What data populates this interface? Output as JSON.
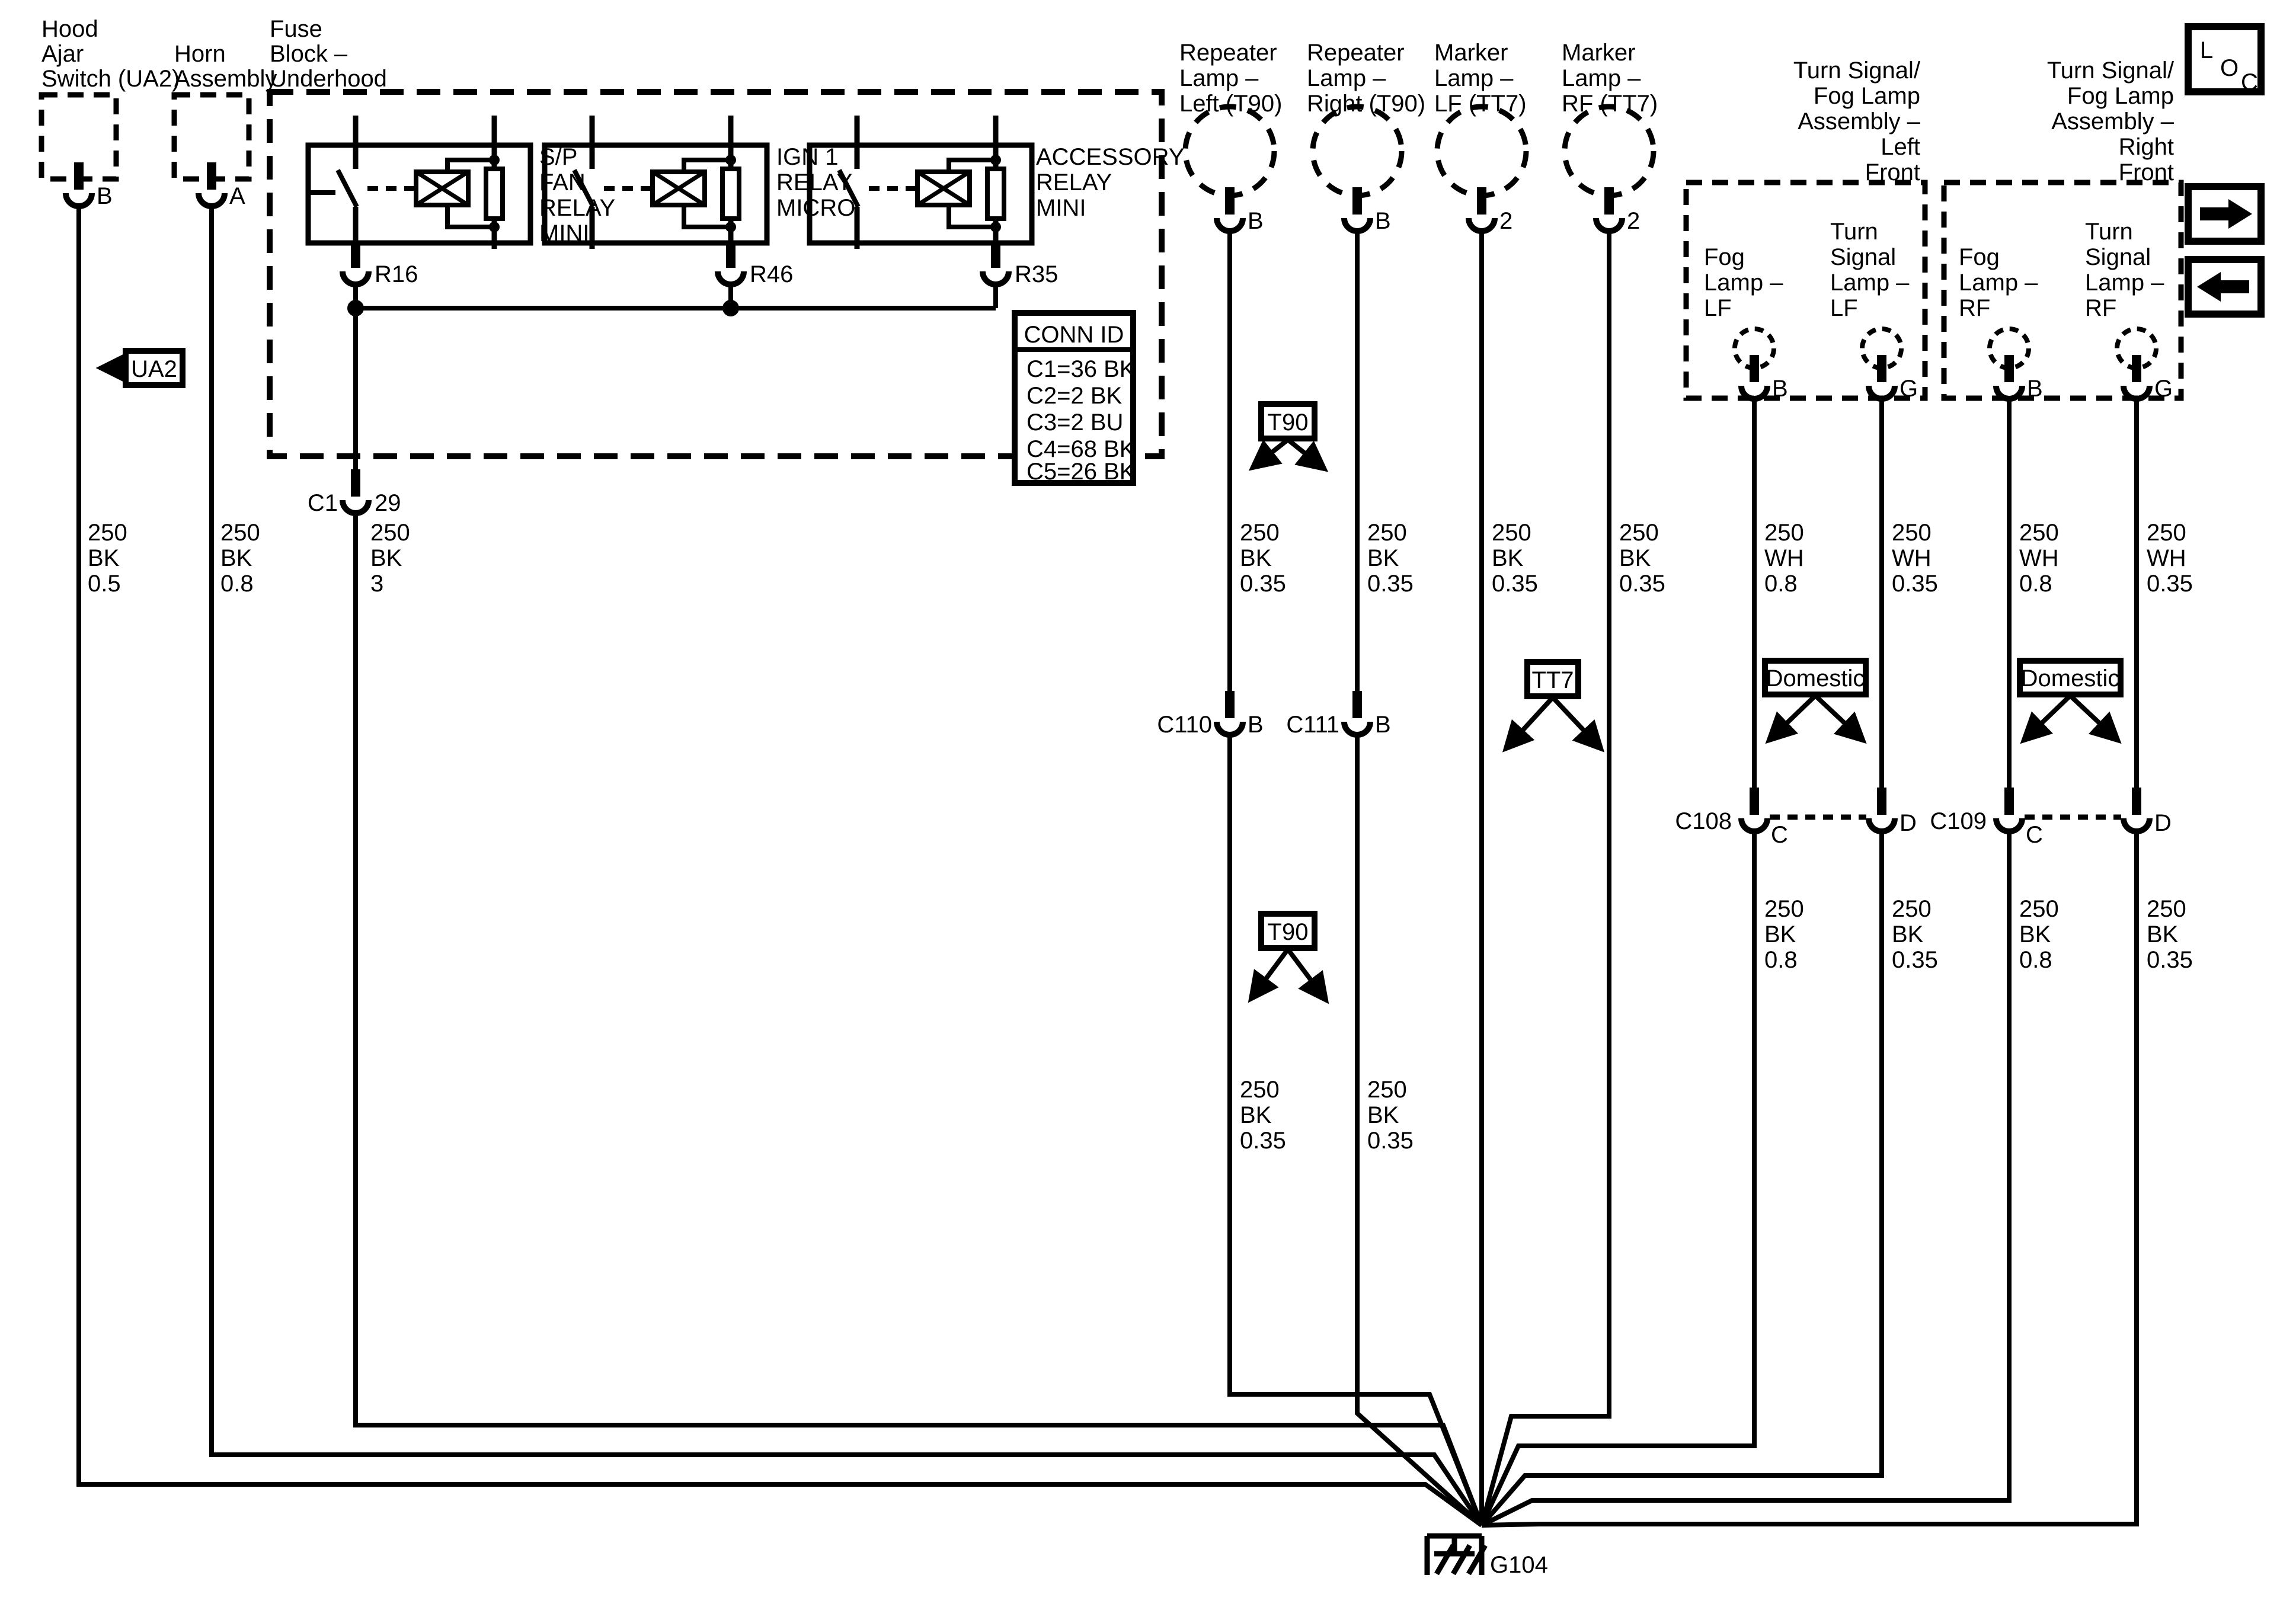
{
  "colors": {
    "ink": "#000000",
    "paper": "#ffffff"
  },
  "hood_ajar": {
    "line1": "Hood",
    "line2": "Ajar",
    "line3": "Switch (UA2)",
    "pin": "B",
    "wire1": "250",
    "wire2": "BK",
    "wire3": "0.5"
  },
  "horn": {
    "line1": "Horn",
    "line2": "Assembly",
    "pin": "A",
    "wire1": "250",
    "wire2": "BK",
    "wire3": "0.8"
  },
  "fuse_block": {
    "line1": "Fuse",
    "line2": "Block –",
    "line3": "Underhood"
  },
  "relay_fan": {
    "line1": "S/P",
    "line2": "FAN",
    "line3": "RELAY",
    "line4": "MINI",
    "pin": "R16"
  },
  "relay_ign": {
    "line1": "IGN 1",
    "line2": "RELAY",
    "line3": "MICRO",
    "pin": "R46"
  },
  "relay_acc": {
    "line1": "ACCESSORY",
    "line2": "RELAY",
    "line3": "MINI",
    "pin": "R35"
  },
  "conn_id": {
    "title": "CONN ID",
    "row1": "C1=36 BK",
    "row2": "C2=2 BK",
    "row3": "C3=2 BU",
    "row4": "C4=68 BK",
    "row5": "C5=26 BK"
  },
  "c1_connector": {
    "name": "C1",
    "pin": "29",
    "wire1": "250",
    "wire2": "BK",
    "wire3": "3"
  },
  "ua2_callout": {
    "label": "UA2"
  },
  "repeater_left": {
    "line1": "Repeater",
    "line2": "Lamp –",
    "line3": "Left (T90)",
    "pin": "B",
    "wire1": "250",
    "wire2": "BK",
    "wire3": "0.35",
    "conn": "C110",
    "conn_pin": "B",
    "wire4": "250",
    "wire5": "BK",
    "wire6": "0.35"
  },
  "repeater_right": {
    "line1": "Repeater",
    "line2": "Lamp –",
    "line3": "Right (T90)",
    "pin": "B",
    "wire1": "250",
    "wire2": "BK",
    "wire3": "0.35",
    "conn": "C111",
    "conn_pin": "B",
    "wire4": "250",
    "wire5": "BK",
    "wire6": "0.35"
  },
  "marker_lf": {
    "line1": "Marker",
    "line2": "Lamp –",
    "line3": "LF (TT7)",
    "pin": "2",
    "wire1": "250",
    "wire2": "BK",
    "wire3": "0.35"
  },
  "marker_rf": {
    "line1": "Marker",
    "line2": "Lamp –",
    "line3": "RF (TT7)",
    "pin": "2",
    "wire1": "250",
    "wire2": "BK",
    "wire3": "0.35"
  },
  "harness_t90_upper": {
    "label": "T90"
  },
  "harness_t90_lower": {
    "label": "T90"
  },
  "harness_tt7": {
    "label": "TT7"
  },
  "domestic_left": {
    "label": "Domestic"
  },
  "domestic_right": {
    "label": "Domestic"
  },
  "assembly_left": {
    "line1": "Turn Signal/",
    "line2": "Fog Lamp",
    "line3": "Assembly –",
    "line4": "Left",
    "line5": "Front"
  },
  "assembly_right": {
    "line1": "Turn Signal/",
    "line2": "Fog Lamp",
    "line3": "Assembly –",
    "line4": "Right",
    "line5": "Front"
  },
  "fog_lf": {
    "line1": "Fog",
    "line2": "Lamp –",
    "line3": "LF",
    "pin": "B",
    "wire1": "250",
    "wire2": "WH",
    "wire3": "0.8",
    "wire4": "250",
    "wire5": "BK",
    "wire6": "0.8"
  },
  "turn_lf": {
    "line1": "Turn",
    "line2": "Signal",
    "line3": "Lamp –",
    "line4": "LF",
    "pin": "G",
    "wire1": "250",
    "wire2": "WH",
    "wire3": "0.35",
    "wire4": "250",
    "wire5": "BK",
    "wire6": "0.35"
  },
  "fog_rf": {
    "line1": "Fog",
    "line2": "Lamp –",
    "line3": "RF",
    "pin": "B",
    "wire1": "250",
    "wire2": "WH",
    "wire3": "0.8",
    "wire4": "250",
    "wire5": "BK",
    "wire6": "0.8"
  },
  "turn_rf": {
    "line1": "Turn",
    "line2": "Signal",
    "line3": "Lamp –",
    "line4": "RF",
    "pin": "G",
    "wire1": "250",
    "wire2": "WH",
    "wire3": "0.35",
    "wire4": "250",
    "wire5": "BK",
    "wire6": "0.35"
  },
  "c108": {
    "name": "C108",
    "pin_left": "C",
    "pin_right": "D"
  },
  "c109": {
    "name": "C109",
    "pin_left": "C",
    "pin_right": "D"
  },
  "ground": {
    "label": "G104"
  },
  "loc_badge": {
    "l": "L",
    "o": "O",
    "c": "C"
  }
}
